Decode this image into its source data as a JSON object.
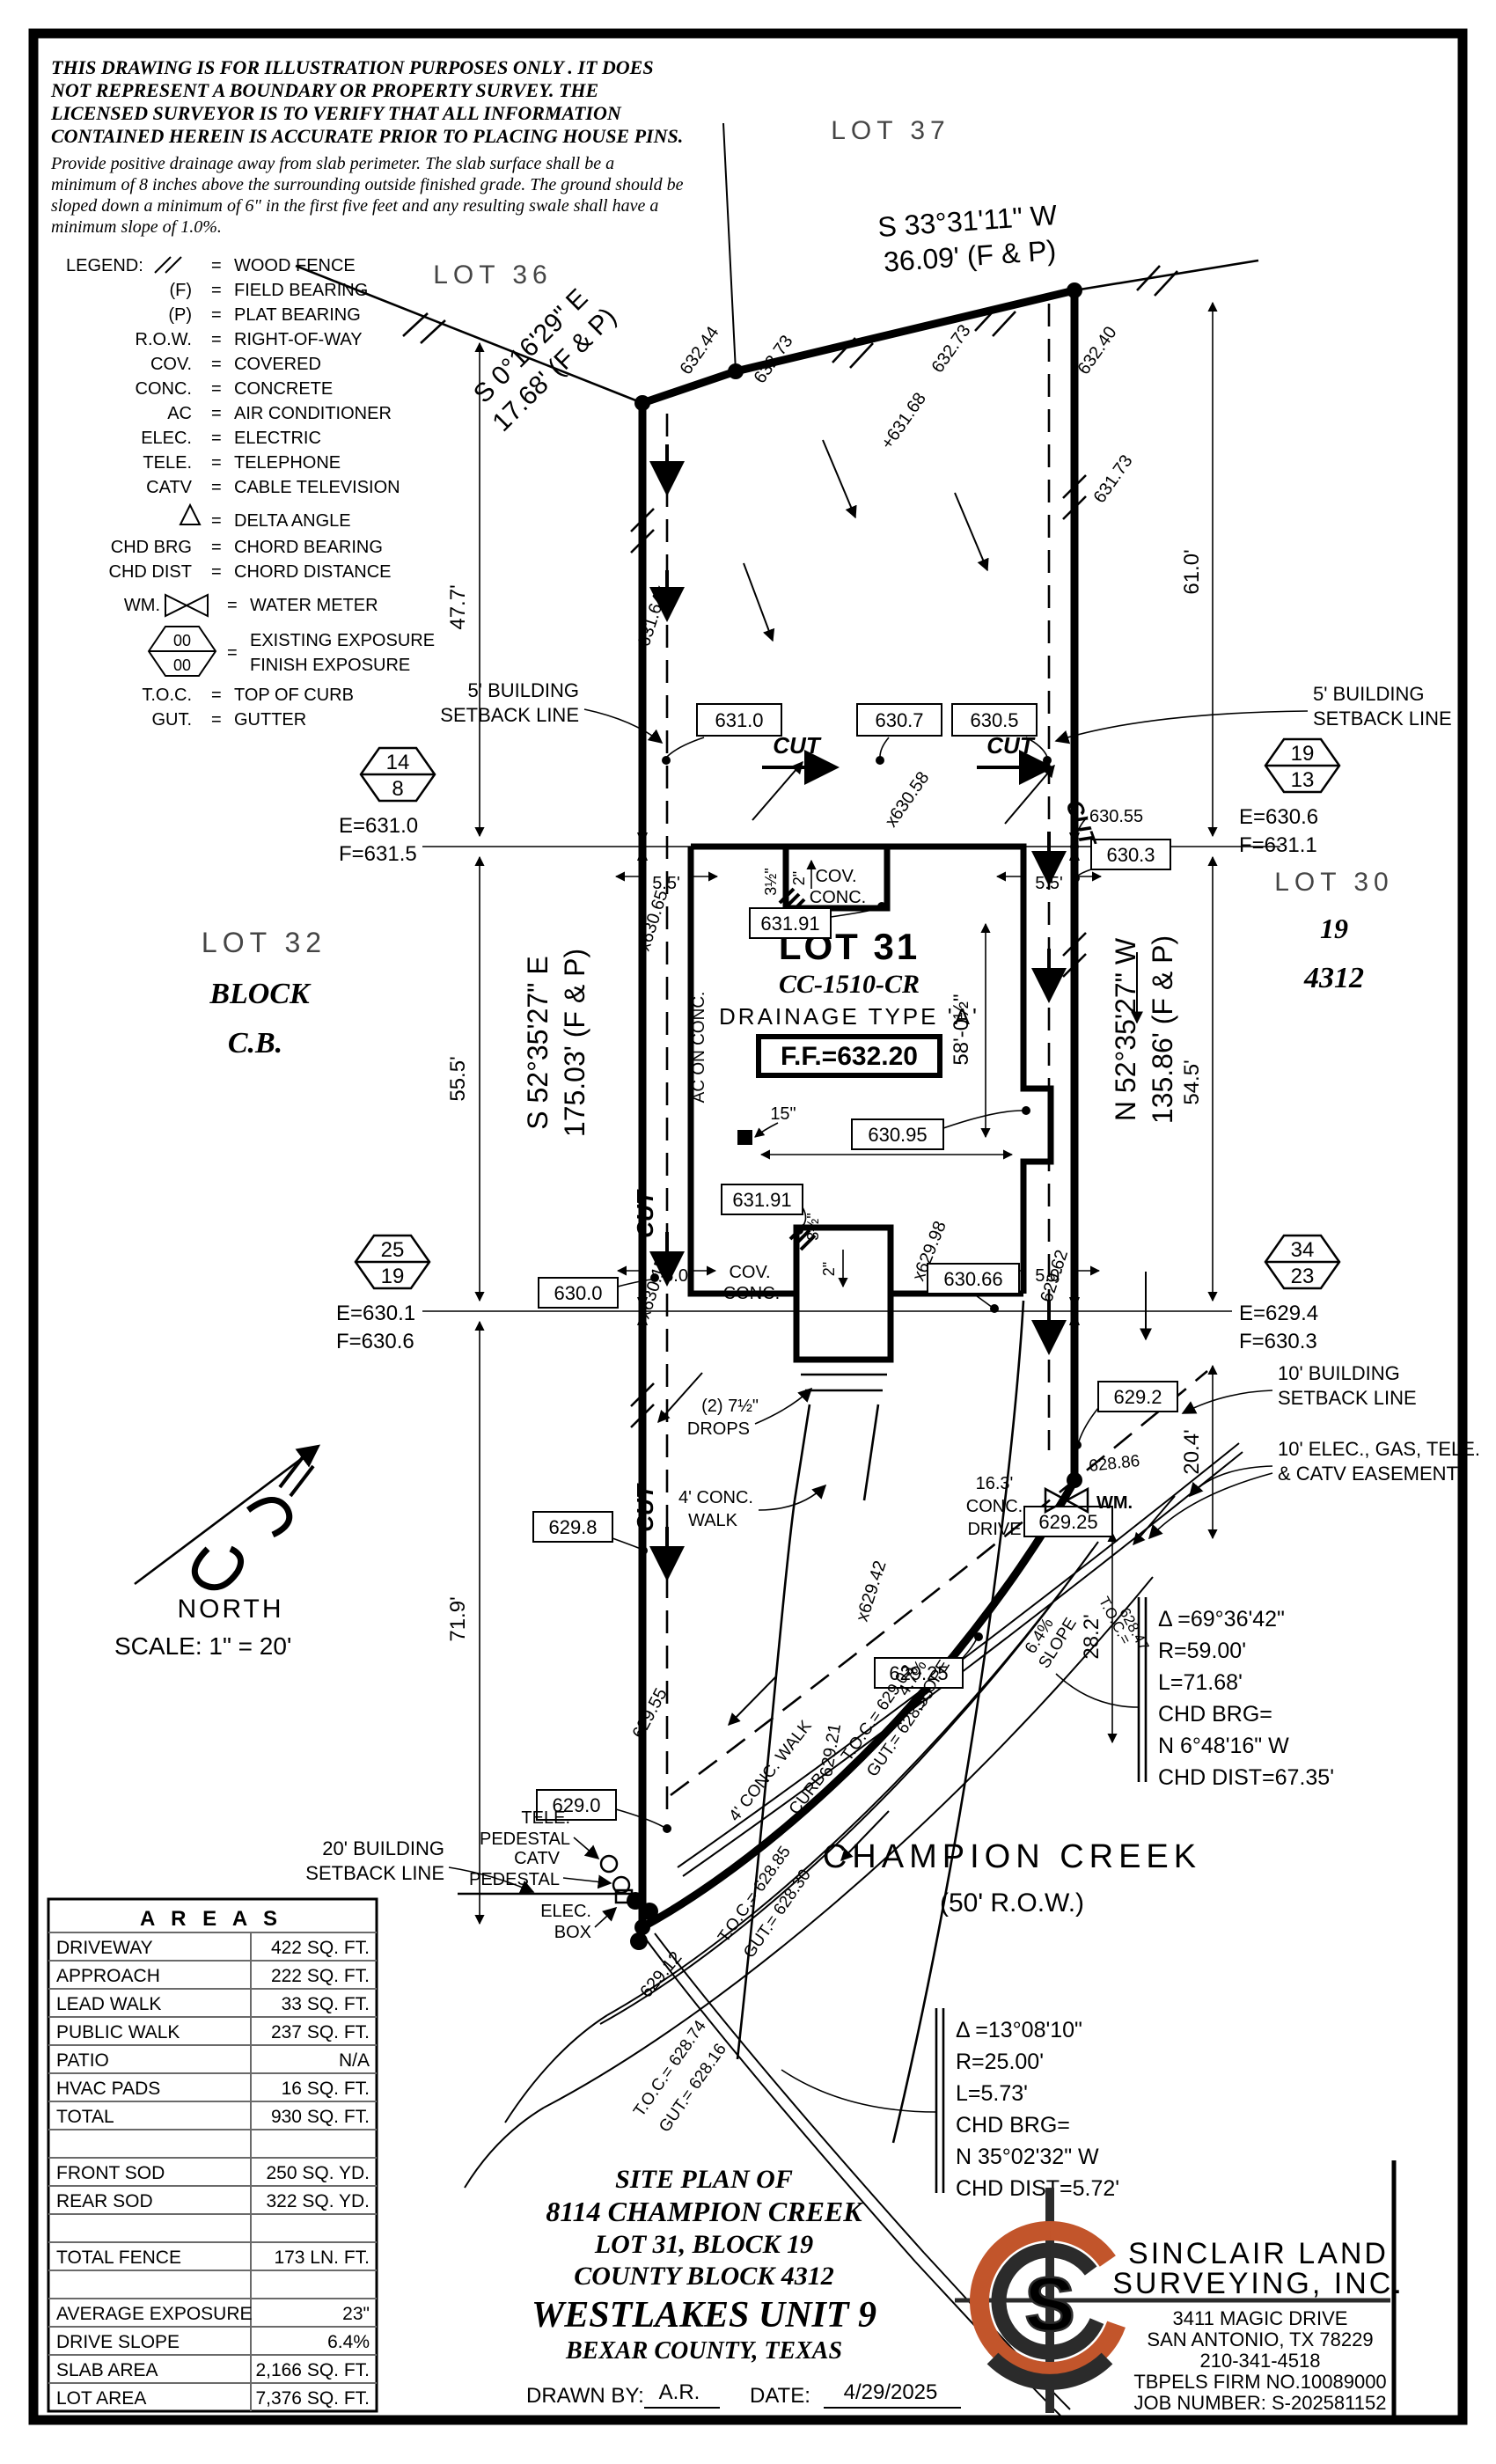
{
  "disclaimer": {
    "lines": [
      "THIS DRAWING IS FOR ILLUSTRATION PURPOSES ONLY . IT DOES",
      "NOT REPRESENT A BOUNDARY OR PROPERTY SURVEY. THE",
      "LICENSED SURVEYOR IS TO VERIFY THAT ALL INFORMATION",
      "CONTAINED HEREIN IS ACCURATE PRIOR TO PLACING HOUSE PINS."
    ]
  },
  "note": {
    "lines": [
      "Provide positive drainage away from slab perimeter. The slab surface shall be a",
      "minimum of 8 inches above the surrounding outside finished grade. The ground should be",
      "sloped down a minimum of 6\" in the first five feet and any resulting swale shall have a",
      "minimum slope of 1.0%."
    ]
  },
  "legend": {
    "title": "LEGEND:",
    "equals": "=",
    "items": [
      {
        "abbr": "",
        "label": "WOOD FENCE"
      },
      {
        "abbr": "(F)",
        "label": "FIELD BEARING"
      },
      {
        "abbr": "(P)",
        "label": "PLAT BEARING"
      },
      {
        "abbr": "R.O.W.",
        "label": "RIGHT-OF-WAY"
      },
      {
        "abbr": "COV.",
        "label": "COVERED"
      },
      {
        "abbr": "CONC.",
        "label": "CONCRETE"
      },
      {
        "abbr": "AC",
        "label": "AIR CONDITIONER"
      },
      {
        "abbr": "ELEC.",
        "label": "ELECTRIC"
      },
      {
        "abbr": "TELE.",
        "label": "TELEPHONE"
      },
      {
        "abbr": "CATV",
        "label": "CABLE TELEVISION"
      },
      {
        "abbr": "",
        "label": "DELTA ANGLE"
      },
      {
        "abbr": "CHD BRG",
        "label": "CHORD BEARING"
      },
      {
        "abbr": "CHD DIST",
        "label": "CHORD DISTANCE"
      },
      {
        "abbr": "WM.",
        "label": "WATER METER"
      },
      {
        "abbr": "00",
        "label": "EXISTING EXPOSURE"
      },
      {
        "abbr": "00",
        "label": "FINISH EXPOSURE"
      },
      {
        "abbr": "T.O.C.",
        "label": "TOP OF CURB"
      },
      {
        "abbr": "GUT.",
        "label": "GUTTER"
      }
    ]
  },
  "north": {
    "label": "NORTH",
    "scale": "SCALE:  1\" = 20'"
  },
  "lots": {
    "lot36": "LOT 36",
    "lot37": "LOT 37",
    "lot32": {
      "name": "LOT 32",
      "l2": "BLOCK",
      "l3": "C.B."
    },
    "lot30": {
      "name": "LOT 30",
      "l2": "19",
      "l3": "4312"
    },
    "lot31": {
      "name": "LOT 31",
      "plan": "CC-1510-CR",
      "drainage": "DRAINAGE TYPE 'A'",
      "ff": "F.F.=632.20"
    }
  },
  "bearings": {
    "top_left": {
      "l1": "S 0°16'29\" E",
      "l2": "17.68' (F & P)"
    },
    "top_right": {
      "l1": "S 33°31'11\" W",
      "l2": "36.09' (F & P)"
    },
    "west": {
      "l1": "S 52°35'27\" E",
      "l2": "175.03' (F & P)"
    },
    "east": {
      "l1": "N 52°35'27\" W",
      "l2": "135.86' (F & P)"
    }
  },
  "dims": {
    "d477": "47.7'",
    "d555": "55.5'",
    "d719": "71.9'",
    "d610": "61.0'",
    "d545": "54.5'",
    "d204": "20.4'",
    "d282": "28.2'",
    "g55": "5.5'",
    "g50": "5.0'",
    "d58": "58'-0½\"",
    "d3911": "39'-11\"",
    "d15": "15\"",
    "d2": "2\"",
    "d35": "3½\"",
    "drive": [
      "16.3'",
      "CONC.",
      "DRIVE"
    ],
    "walk": [
      "4' CONC.",
      "WALK"
    ],
    "walk_curve": "4' CONC. WALK",
    "curb": "CURB",
    "drops": [
      "(2) 7½\"",
      "DROPS"
    ],
    "slope47": "4.7%",
    "slope64": "6.4%",
    "slope_word": "SLOPE"
  },
  "setbacks": {
    "five": [
      "5' BUILDING",
      "SETBACK LINE"
    ],
    "ten_bldg": [
      "10' BUILDING",
      "SETBACK LINE"
    ],
    "ten_esmt": [
      "10' ELEC., GAS, TELE.",
      "& CATV EASEMENT"
    ],
    "twenty": [
      "20' BUILDING",
      "SETBACK LINE"
    ]
  },
  "boxes": {
    "b631_0": "631.0",
    "b630_7": "630.7",
    "b630_5": "630.5",
    "b630_3": "630.3",
    "b630_0": "630.0",
    "b630_95": "630.95",
    "b630_66": "630.66",
    "b629_8": "629.8",
    "b629_2": "629.2",
    "b629_25a": "629.25",
    "b629_25b": "629.25",
    "b629_0": "629.0",
    "b631_91a": "631.91",
    "b631_91b": "631.91"
  },
  "spots": {
    "s632_44": "632.44",
    "s632_73a": "632.73",
    "s632_73b": "632.73",
    "s631_68": "+631.68",
    "s632_40": "632.40",
    "s631_73": "631.73",
    "s631_64": "631.64x",
    "s630_65": "x630.65",
    "s630_15": "x630.15",
    "s629_55": "629.55",
    "s629_12": "629.12",
    "s629_62": "629.62",
    "s630_58": "x630.58",
    "s629_98": "x629.98",
    "s629_42": "x629.42",
    "s629_21": "629.21",
    "s628_86": "628.86",
    "s630_55": "630.55"
  },
  "labels": {
    "cut": "CUT",
    "ac": "AC ON CONC.",
    "cov": [
      "COV.",
      "CONC."
    ],
    "tele": [
      "TELE.",
      "PEDESTAL"
    ],
    "catv": [
      "CATV",
      "PEDESTAL"
    ],
    "elec": [
      "ELEC.",
      "BOX"
    ],
    "wm": "WM."
  },
  "curve1": {
    "delta": "Δ =69°36'42\"",
    "r": "R=59.00'",
    "l": "L=71.68'",
    "brg1": "CHD BRG=",
    "brg2": "N 6°48'16\" W",
    "dist": "CHD DIST=67.35'"
  },
  "curve2": {
    "delta": "Δ =13°08'10\"",
    "r": "R=25.00'",
    "l": "L=5.73'",
    "brg1": "CHD BRG=",
    "brg2": "N 35°02'32\" W",
    "dist": "CHD DIST=5.72'"
  },
  "toc": {
    "p1a": "T.O.C.= 629.03",
    "p1b": "GUT.= 628.53",
    "p2a": "T.O.C.= 628.85",
    "p2b": "GUT.= 628.30",
    "p3a": "T.O.C.= 628.74",
    "p3b": "GUT.= 628.16",
    "s1a": "T.O.C.=",
    "s1b": "628.47"
  },
  "street": {
    "name": "CHAMPION CREEK",
    "row": "(50' R.O.W.)"
  },
  "hex": [
    {
      "top": "14",
      "bot": "8",
      "e": "E=631.0",
      "f": "F=631.5"
    },
    {
      "top": "19",
      "bot": "13",
      "e": "E=630.6",
      "f": "F=631.1"
    },
    {
      "top": "25",
      "bot": "19",
      "e": "E=630.1",
      "f": "F=630.6"
    },
    {
      "top": "34",
      "bot": "23",
      "e": "E=629.4",
      "f": "F=630.3"
    }
  ],
  "areas": {
    "title": "A R E A S",
    "rows": [
      {
        "label": "DRIVEWAY",
        "value": "422 SQ. FT."
      },
      {
        "label": "APPROACH",
        "value": "222 SQ. FT."
      },
      {
        "label": "LEAD WALK",
        "value": "33 SQ. FT."
      },
      {
        "label": "PUBLIC WALK",
        "value": "237 SQ. FT."
      },
      {
        "label": "PATIO",
        "value": "N/A"
      },
      {
        "label": "HVAC PADS",
        "value": "16 SQ. FT."
      },
      {
        "label": "TOTAL",
        "value": "930 SQ. FT."
      },
      {
        "label": "",
        "value": ""
      },
      {
        "label": "FRONT SOD",
        "value": "250 SQ. YD."
      },
      {
        "label": "REAR SOD",
        "value": "322 SQ. YD."
      },
      {
        "label": "",
        "value": ""
      },
      {
        "label": "TOTAL FENCE",
        "value": "173 LN. FT."
      },
      {
        "label": "",
        "value": ""
      },
      {
        "label": "AVERAGE EXPOSURE",
        "value": "23\""
      },
      {
        "label": "DRIVE SLOPE",
        "value": "6.4%"
      },
      {
        "label": "SLAB AREA",
        "value": "2,166 SQ. FT."
      },
      {
        "label": "LOT AREA",
        "value": "7,376 SQ. FT."
      }
    ]
  },
  "titleblock": {
    "lines": [
      "SITE PLAN OF",
      "8114 CHAMPION CREEK",
      "LOT 31, BLOCK 19",
      "COUNTY BLOCK 4312",
      "WESTLAKES UNIT 9",
      "BEXAR COUNTY, TEXAS"
    ],
    "drawn_label": "DRAWN BY:",
    "drawn": "A.R.",
    "date_label": "DATE:",
    "date": "4/29/2025"
  },
  "company": {
    "name1": "SINCLAIR LAND",
    "name2": "SURVEYING, INC.",
    "logo_s": "S",
    "addr": [
      "3411 MAGIC DRIVE",
      "SAN ANTONIO, TX 78229",
      "210-341-4518",
      "TBPELS FIRM NO.10089000",
      "JOB NUMBER: S-202581152"
    ]
  },
  "colors": {
    "ink": "#000000",
    "accent_orange": "#C2552B"
  }
}
